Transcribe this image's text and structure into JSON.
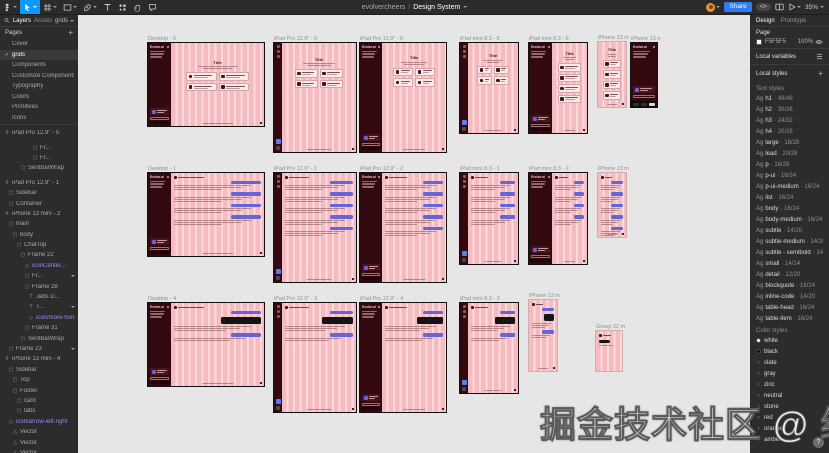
{
  "toolbar": {
    "breadcrumb_user": "evolvercheers",
    "breadcrumb_sep": "/",
    "file_name": "Design System",
    "share_label": "Share",
    "dev_toggle_label": "</>",
    "zoom_level": "35%"
  },
  "left_panel": {
    "tab_layers": "Layers",
    "tab_assets": "Assets",
    "page_dropdown": "grids",
    "pages_header": "Pages",
    "add_page_label": "+",
    "pages": [
      {
        "name": "Cover"
      },
      {
        "name": "grids",
        "selected": true
      },
      {
        "name": "Components"
      },
      {
        "name": "Customize Components"
      },
      {
        "name": "Typography"
      },
      {
        "name": "Colors"
      },
      {
        "name": "Primitives"
      },
      {
        "name": "Icons"
      }
    ],
    "layers": [
      {
        "name": "iPad Pro 12.9\" - 5",
        "indent": 0,
        "icon": "#"
      },
      {
        "name": "Fr...",
        "indent": 7,
        "icon": "▢",
        "gap": true
      },
      {
        "name": "Fr...",
        "indent": 7,
        "icon": "▢"
      },
      {
        "name": "SentBarWrap",
        "indent": 4,
        "icon": "▢"
      },
      {
        "name": "iPad Pro 12.9\" - 1",
        "indent": 0,
        "icon": "#",
        "gap": true
      },
      {
        "name": "Sidebar",
        "indent": 1,
        "icon": "▢"
      },
      {
        "name": "Container",
        "indent": 1,
        "icon": "▢"
      },
      {
        "name": "iPhone 13 mini - 2",
        "indent": 0,
        "icon": "#"
      },
      {
        "name": "main",
        "indent": 1,
        "icon": "▢"
      },
      {
        "name": "body",
        "indent": 2,
        "icon": "▢"
      },
      {
        "name": "ChatTop",
        "indent": 3,
        "icon": "▢"
      },
      {
        "name": "Frame 22",
        "indent": 4,
        "icon": "▢"
      },
      {
        "name": "iconCenter...",
        "indent": 5,
        "icon": "◇",
        "purple": true
      },
      {
        "name": "Fr...",
        "indent": 5,
        "icon": "▢",
        "chevron": true
      },
      {
        "name": "Frame 28",
        "indent": 5,
        "icon": "▢"
      },
      {
        "name": "Jabs D...",
        "indent": 6,
        "icon": "T"
      },
      {
        "name": "T...",
        "indent": 6,
        "icon": "T",
        "chevron": true
      },
      {
        "name": "icon/more-horiz...",
        "indent": 6,
        "icon": "◇",
        "purple": true
      },
      {
        "name": "Frame 31",
        "indent": 5,
        "icon": "▢"
      },
      {
        "name": "SentBarWrap",
        "indent": 4,
        "icon": "▢"
      },
      {
        "name": "Frame 23",
        "indent": 1,
        "icon": "▢",
        "chevron": true
      },
      {
        "name": "iPhone 13 mini - 4",
        "indent": 0,
        "icon": "#"
      },
      {
        "name": "Sidebar",
        "indent": 1,
        "icon": "▢"
      },
      {
        "name": "Top",
        "indent": 2,
        "icon": "▢"
      },
      {
        "name": "Footer",
        "indent": 2,
        "icon": "▢"
      },
      {
        "name": "card",
        "indent": 3,
        "icon": "▢"
      },
      {
        "name": "tabs",
        "indent": 3,
        "icon": "▢"
      },
      {
        "name": "icon/arrow-left-right",
        "indent": 1,
        "icon": "◇",
        "purple": true
      },
      {
        "name": "Vector",
        "indent": 2,
        "icon": "△"
      },
      {
        "name": "Vector",
        "indent": 2,
        "icon": "△"
      },
      {
        "name": "Vector",
        "indent": 2,
        "icon": "△"
      }
    ]
  },
  "right_panel": {
    "tab_design": "Design",
    "tab_prototype": "Prototype",
    "page_section_title": "Page",
    "page_color_hex": "F5F5F5",
    "page_color_opacity": "100%",
    "local_variables_label": "Local variables",
    "local_styles_label": "Local styles",
    "add_style_label": "+",
    "text_styles_label": "Text styles",
    "ag_preview": "Ag",
    "dot": "·",
    "text_styles": [
      {
        "name": "h1",
        "size": "48/48"
      },
      {
        "name": "h2",
        "size": "30/36"
      },
      {
        "name": "h3",
        "size": "24/32"
      },
      {
        "name": "h4",
        "size": "20/28"
      },
      {
        "name": "large",
        "size": "18/28"
      },
      {
        "name": "lead",
        "size": "20/28"
      },
      {
        "name": "p",
        "size": "16/28"
      },
      {
        "name": "p-ui",
        "size": "16/24"
      },
      {
        "name": "p-ui-medium",
        "size": "16/24"
      },
      {
        "name": "list",
        "size": "16/24"
      },
      {
        "name": "body",
        "size": "16/24"
      },
      {
        "name": "body-medium",
        "size": "16/24"
      },
      {
        "name": "subtle",
        "size": "14/20"
      },
      {
        "name": "subtle-medium",
        "size": "14/20"
      },
      {
        "name": "subtle - semibold",
        "size": "14/20"
      },
      {
        "name": "small",
        "size": "14/14"
      },
      {
        "name": "detail",
        "size": "12/20"
      },
      {
        "name": "blockquote",
        "size": "16/24"
      },
      {
        "name": "inline-code",
        "size": "14/20"
      },
      {
        "name": "table-head",
        "size": "16/24"
      },
      {
        "name": "table-item",
        "size": "16/24"
      }
    ],
    "color_styles_label": "Color styles",
    "color_styles": [
      {
        "name": "white",
        "swatch": "#ffffff"
      },
      {
        "name": "black",
        "swatch": "#0d0d0d"
      },
      {
        "name": "slate",
        "group": true
      },
      {
        "name": "gray",
        "group": true
      },
      {
        "name": "zinc",
        "group": true
      },
      {
        "name": "neutral",
        "group": true
      },
      {
        "name": "stone",
        "group": true
      },
      {
        "name": "red",
        "group": true
      },
      {
        "name": "orange",
        "group": true
      },
      {
        "name": "amber",
        "group": true
      }
    ]
  },
  "canvas": {
    "frame_mock": {
      "logo": "Evolve.ai",
      "title": "Title"
    },
    "frames": [
      {
        "label": "Desktop - 5",
        "x": 147,
        "y": 42,
        "w": 118,
        "h": 85,
        "kind": "landing",
        "side": "sidebar",
        "sideW": 20,
        "cols": 2,
        "border": "thick"
      },
      {
        "label": "iPad Pro 12.9\" - 5",
        "x": 273,
        "y": 42,
        "w": 84,
        "h": 111,
        "kind": "landing",
        "side": "rail",
        "cols": 2,
        "border": "thick"
      },
      {
        "label": "iPad Pro 12.9\" - 6",
        "x": 359,
        "y": 42,
        "w": 88,
        "h": 111,
        "kind": "landing",
        "side": "sidebar",
        "sideW": 26,
        "cols": 2,
        "border": "thick"
      },
      {
        "label": "iPad mini 8.3 - 5",
        "x": 459,
        "y": 42,
        "w": 60,
        "h": 92,
        "kind": "landing",
        "side": "rail",
        "cols": 2,
        "border": "thick"
      },
      {
        "label": "iPad mini 8.3 - 6",
        "x": 528,
        "y": 42,
        "w": 60,
        "h": 92,
        "kind": "landing",
        "side": "sidebar",
        "sideW": 40,
        "cols": 1,
        "border": "thick"
      },
      {
        "label": "iPhone 13 min...",
        "x": 597,
        "y": 41,
        "w": 30,
        "h": 67,
        "kind": "landing",
        "side": "none",
        "cols": 1,
        "border": "thin"
      },
      {
        "label": "iPhone 13 mini ...",
        "x": 630,
        "y": 42,
        "w": 28,
        "h": 66,
        "kind": "menu-dark",
        "side": "full",
        "border": "dark"
      },
      {
        "label": "Desktop - 1",
        "x": 147,
        "y": 172,
        "w": 118,
        "h": 85,
        "kind": "chat",
        "side": "sidebar",
        "sideW": 20,
        "border": "thick"
      },
      {
        "label": "iPad Pro 12.9\" - 1",
        "x": 273,
        "y": 172,
        "w": 84,
        "h": 111,
        "kind": "chat",
        "side": "rail",
        "border": "thick"
      },
      {
        "label": "iPad Pro 12.9\" - 2",
        "x": 359,
        "y": 172,
        "w": 88,
        "h": 111,
        "kind": "chat",
        "side": "sidebar",
        "sideW": 26,
        "border": "thick"
      },
      {
        "label": "iPad mini 8.3 - 1",
        "x": 459,
        "y": 172,
        "w": 60,
        "h": 93,
        "kind": "chat",
        "side": "rail",
        "border": "thick"
      },
      {
        "label": "iPad mini 8.3 - 2",
        "x": 528,
        "y": 172,
        "w": 60,
        "h": 93,
        "kind": "chat",
        "side": "sidebar",
        "sideW": 40,
        "border": "thick"
      },
      {
        "label": "iPhone 13 min...",
        "x": 597,
        "y": 172,
        "w": 30,
        "h": 66,
        "kind": "chat",
        "side": "none",
        "border": "thin"
      },
      {
        "label": "Desktop - 4",
        "x": 147,
        "y": 302,
        "w": 118,
        "h": 85,
        "kind": "chat-menu",
        "side": "sidebar",
        "sideW": 20,
        "border": "thick"
      },
      {
        "label": "iPad Pro 12.9\" - 3",
        "x": 273,
        "y": 302,
        "w": 84,
        "h": 111,
        "kind": "chat-menu",
        "side": "rail",
        "border": "thick"
      },
      {
        "label": "iPad Pro 12.9\" - 4",
        "x": 359,
        "y": 302,
        "w": 88,
        "h": 111,
        "kind": "chat-menu",
        "side": "sidebar",
        "sideW": 26,
        "border": "thick"
      },
      {
        "label": "iPad mini 8.3 - 3",
        "x": 459,
        "y": 302,
        "w": 60,
        "h": 92,
        "kind": "chat-menu",
        "side": "rail",
        "border": "thick"
      },
      {
        "label": "iPhone 13 mini",
        "x": 528,
        "y": 299,
        "w": 30,
        "h": 73,
        "kind": "chat-menu",
        "side": "none",
        "border": "thin"
      },
      {
        "label": "Group 32 mm...",
        "x": 595,
        "y": 330,
        "w": 28,
        "h": 42,
        "kind": "mini",
        "side": "none",
        "border": "thin"
      }
    ],
    "watermark": "掘金技术社区 @ 继小鹏",
    "help_label": "?"
  },
  "glyphs": {
    "check": "✓",
    "plus": "+",
    "group_chevron": "›",
    "chevron_down": "˅"
  }
}
